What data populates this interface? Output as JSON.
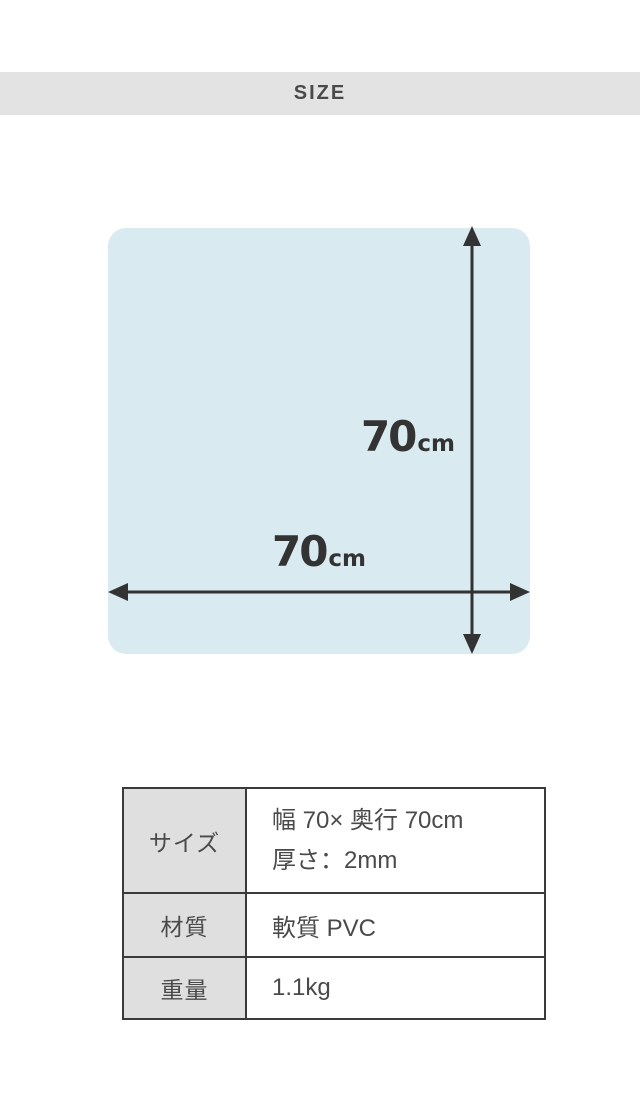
{
  "page": {
    "background": "#ffffff"
  },
  "size_header": {
    "label": "SIZE",
    "background": "#e3e3e3",
    "text_color": "#4a4a4a"
  },
  "diagram": {
    "shape": "rounded-square-mat",
    "fill_color": "#d9eaf1",
    "arrow_color": "#333333",
    "width_label": {
      "value": "70",
      "unit": "cm"
    },
    "height_label": {
      "value": "70",
      "unit": "cm"
    }
  },
  "spec_table": {
    "border_color": "#3a3a3a",
    "header_background": "#dfdfdf",
    "rows": [
      {
        "label": "サイズ",
        "value_lines": [
          "幅 70× 奥行 70cm",
          "厚さ：2mm"
        ]
      },
      {
        "label": "材質",
        "value_lines": [
          "軟質 PVC"
        ]
      },
      {
        "label": "重量",
        "value_lines": [
          "1.1kg"
        ]
      }
    ]
  }
}
